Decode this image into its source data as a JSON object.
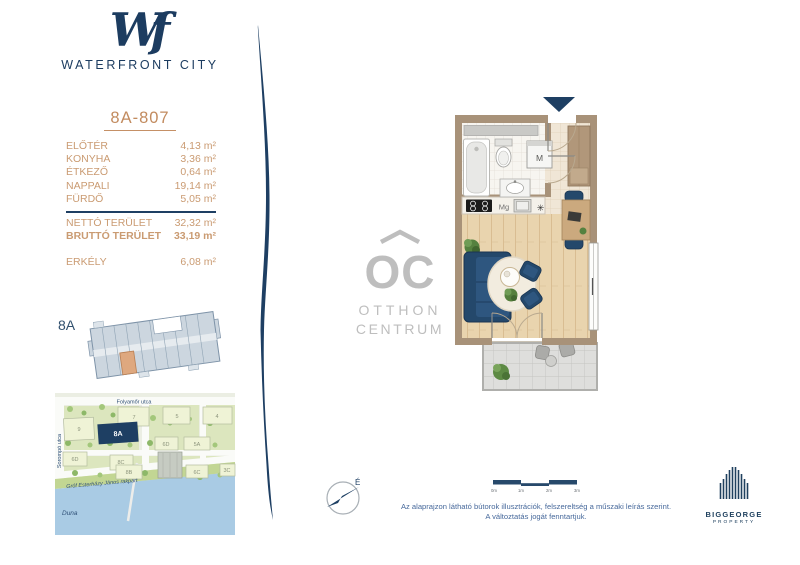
{
  "brand": {
    "monogram": "Wf",
    "name": "WATERFRONT CITY"
  },
  "unit": {
    "title": "8A-807",
    "rooms": [
      {
        "label": "ELŐTÉR",
        "value": "4,13 m²"
      },
      {
        "label": "KONYHA",
        "value": "3,36 m²"
      },
      {
        "label": "ÉTKEZŐ",
        "value": "0,64 m²"
      },
      {
        "label": "NAPPALI",
        "value": "19,14 m²"
      },
      {
        "label": "FÜRDŐ",
        "value": "5,05 m²"
      }
    ],
    "net": {
      "label": "NETTÓ TERÜLET",
      "value": "32,32 m²"
    },
    "gross": {
      "label": "BRUTTÓ TERÜLET",
      "value": "33,19 m²"
    },
    "balcony": {
      "label": "ERKÉLY",
      "value": "6,08 m²"
    }
  },
  "floorplate": {
    "label": "8A"
  },
  "sitemap": {
    "street_top": "Folyamőr utca",
    "street_left": "Sorompó utca",
    "street_embankment": "Gróf Esterházy János rakpart",
    "river": "Duna",
    "buildings": [
      "9",
      "7",
      "5",
      "4",
      "8A",
      "6D",
      "5A",
      "6D",
      "8C",
      "8B",
      "6C",
      "3C"
    ]
  },
  "plan": {
    "washer_label": "M",
    "microwave_label": "Mg",
    "fridge_symbol": "✳"
  },
  "watermark": {
    "monogram": "OC",
    "line1": "OTTHON",
    "line2": "CENTRUM"
  },
  "compass": {
    "north_label": "É"
  },
  "scalebar": {
    "ticks": [
      "0m",
      "1m",
      "2m",
      "3m"
    ]
  },
  "disclaimer": {
    "line1": "Az alaprajzon látható bútorok illusztrációk, felszereltség a műszaki leírás szerint.",
    "line2": "A változtatás jogát fenntartjuk."
  },
  "developer": {
    "name": "BIGGEORGE",
    "sub": "PROPERTY"
  },
  "colors": {
    "navy": "#1E3F63",
    "tan_text": "#CA9B72",
    "wall": "#A89279",
    "unit_highlight": "#DEA87F",
    "watermark": "#BEBEBE",
    "river": "#A9CBE4"
  }
}
